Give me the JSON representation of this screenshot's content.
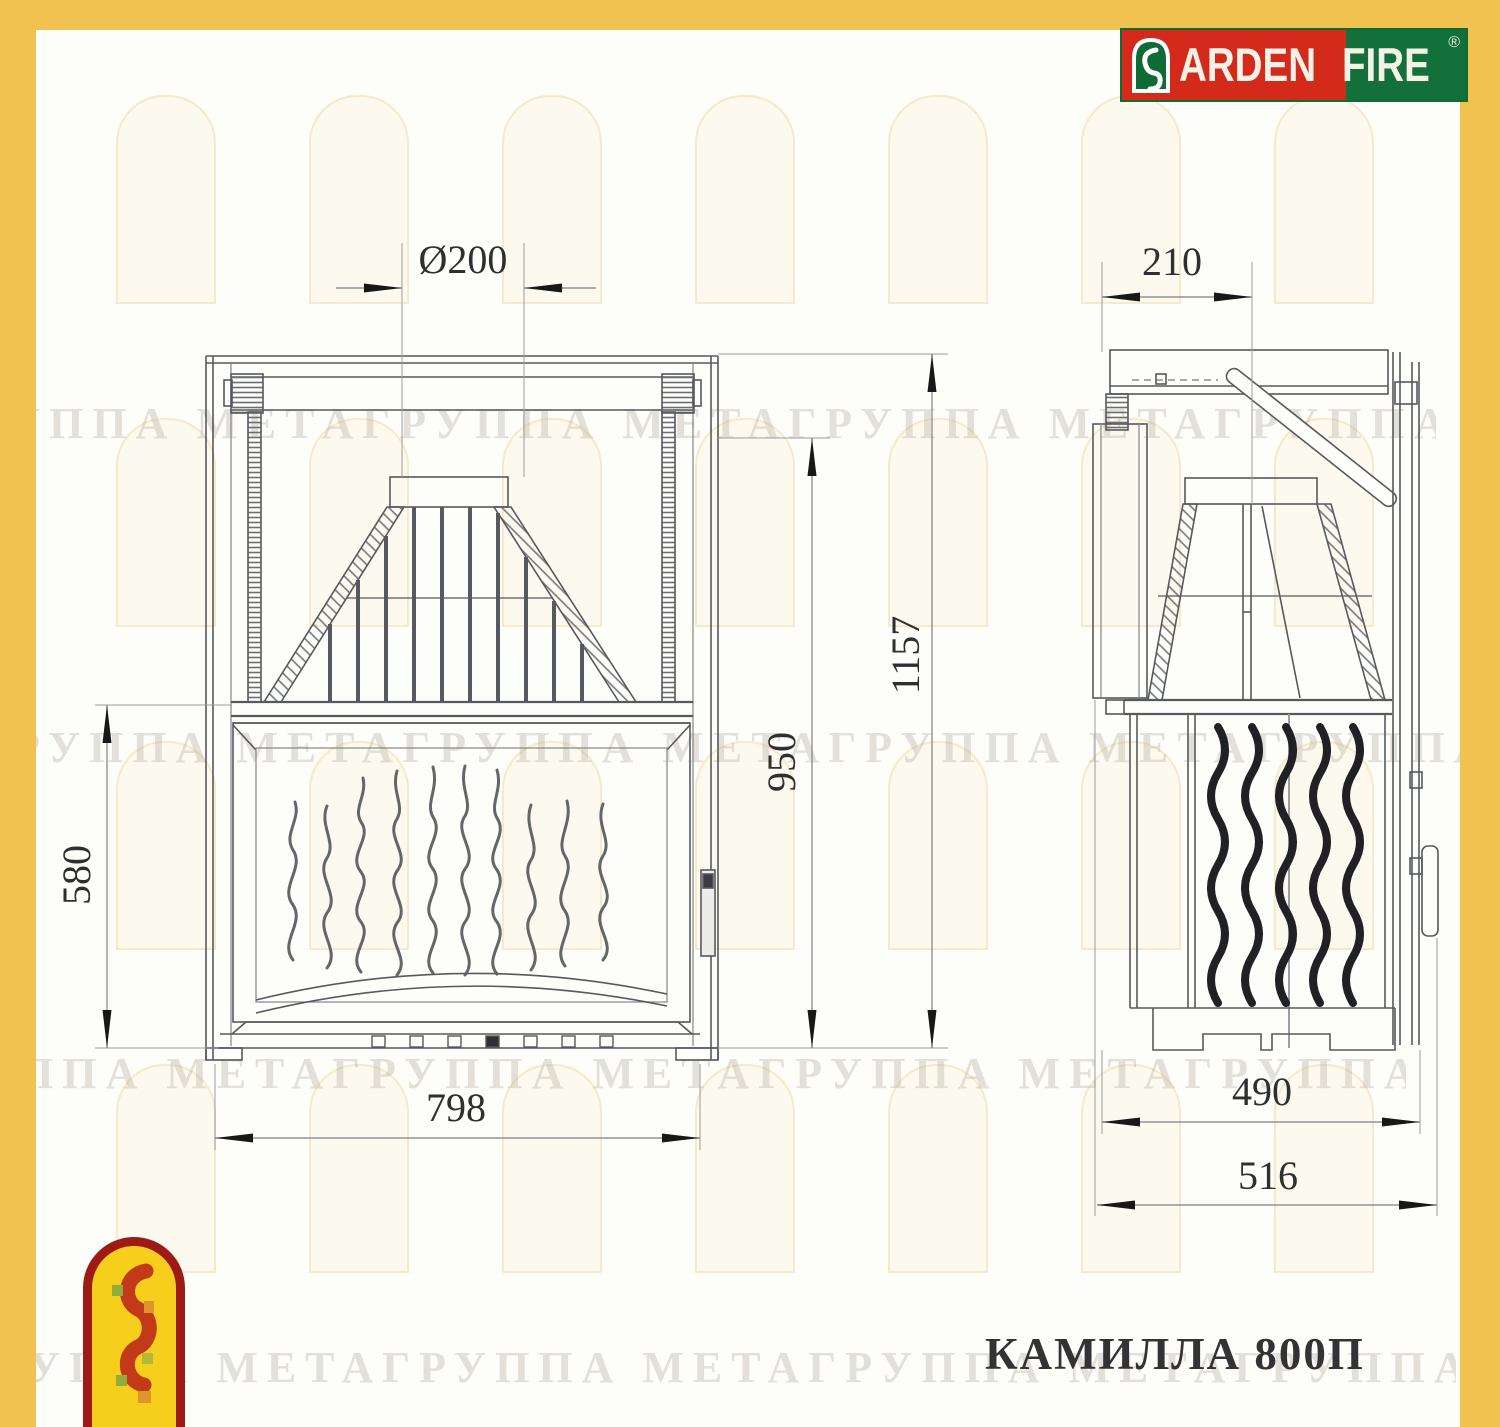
{
  "brand": {
    "arden": "ARDEN",
    "fire": "FIRE",
    "registered": "®"
  },
  "product_title": "КАМИЛЛА 800П",
  "watermark_text": "ГРУППА МЕТАГРУППА МЕТАГРУППА МЕТАГРУППА МЕТА",
  "dimensions": {
    "flue_diameter": "Ø200",
    "firebox_height": "580",
    "opening_height": "950",
    "overall_height": "1157",
    "overall_width": "798",
    "flue_offset_depth": "210",
    "body_depth": "490",
    "overall_depth": "516"
  },
  "colors": {
    "frame_yellow": "#F2C250",
    "brand_red": "#D42A1C",
    "brand_green": "#14703A",
    "emblem_yellow": "#F6CE1C",
    "emblem_red": "#9E1B15",
    "line_gray": "#56595e"
  }
}
